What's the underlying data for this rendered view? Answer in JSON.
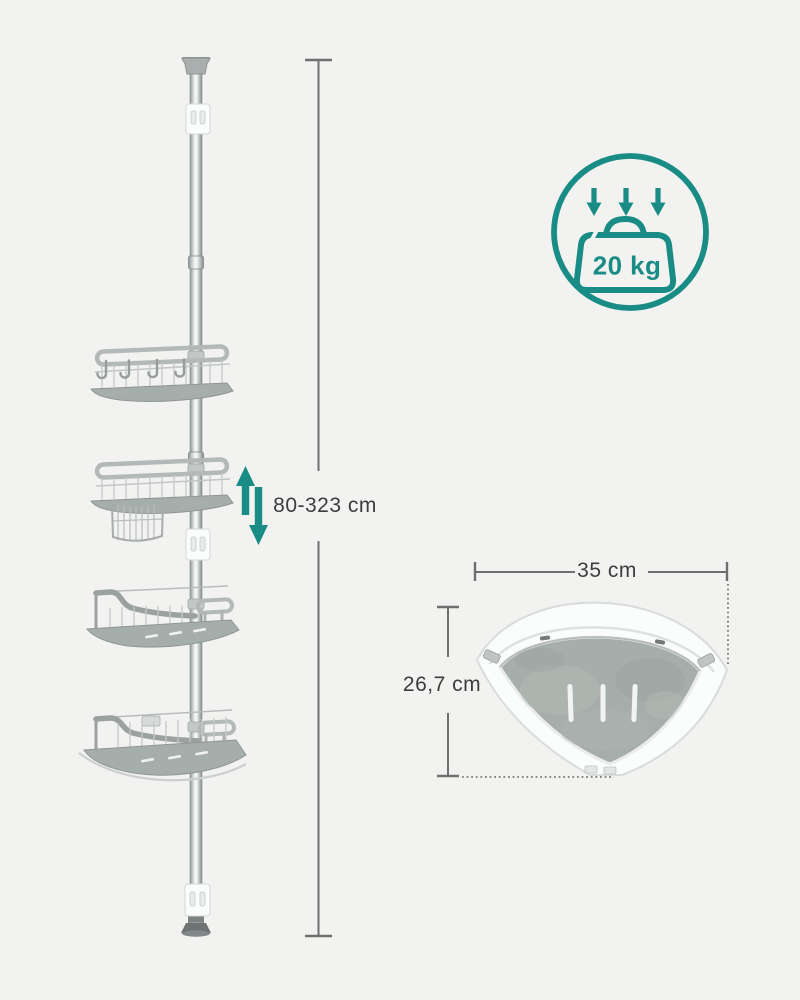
{
  "meta": {
    "type": "product-dimension-diagram",
    "product": "telescopic corner shower shelf on floor-to-ceiling tension pole"
  },
  "colors": {
    "background": "#f2f2f1",
    "accent_teal": "#1a8c86",
    "dimension_line": "#6f6f6f",
    "label_text": "#3d3d3d",
    "shelf_surface": "#a6aeab",
    "metal_light": "#c9cdcc",
    "white_parts": "#fbfcfc"
  },
  "side_view": {
    "description": "pole with four corner shelves, hooks, hanging wire basket, wall brackets",
    "shelf_count": 4,
    "hook_count": 4,
    "height_dimension": {
      "label": "80-323 cm"
    },
    "height_adjust_icon": "up-down-arrows"
  },
  "load_badge": {
    "icon": "weight-with-three-down-arrows",
    "label": "20 kg"
  },
  "top_view": {
    "description": "fan-shaped corner shelf seen from above with three drain slots",
    "drain_slot_count": 3,
    "width_dimension": {
      "label": "35 cm"
    },
    "depth_dimension": {
      "label": "26,7 cm"
    }
  }
}
